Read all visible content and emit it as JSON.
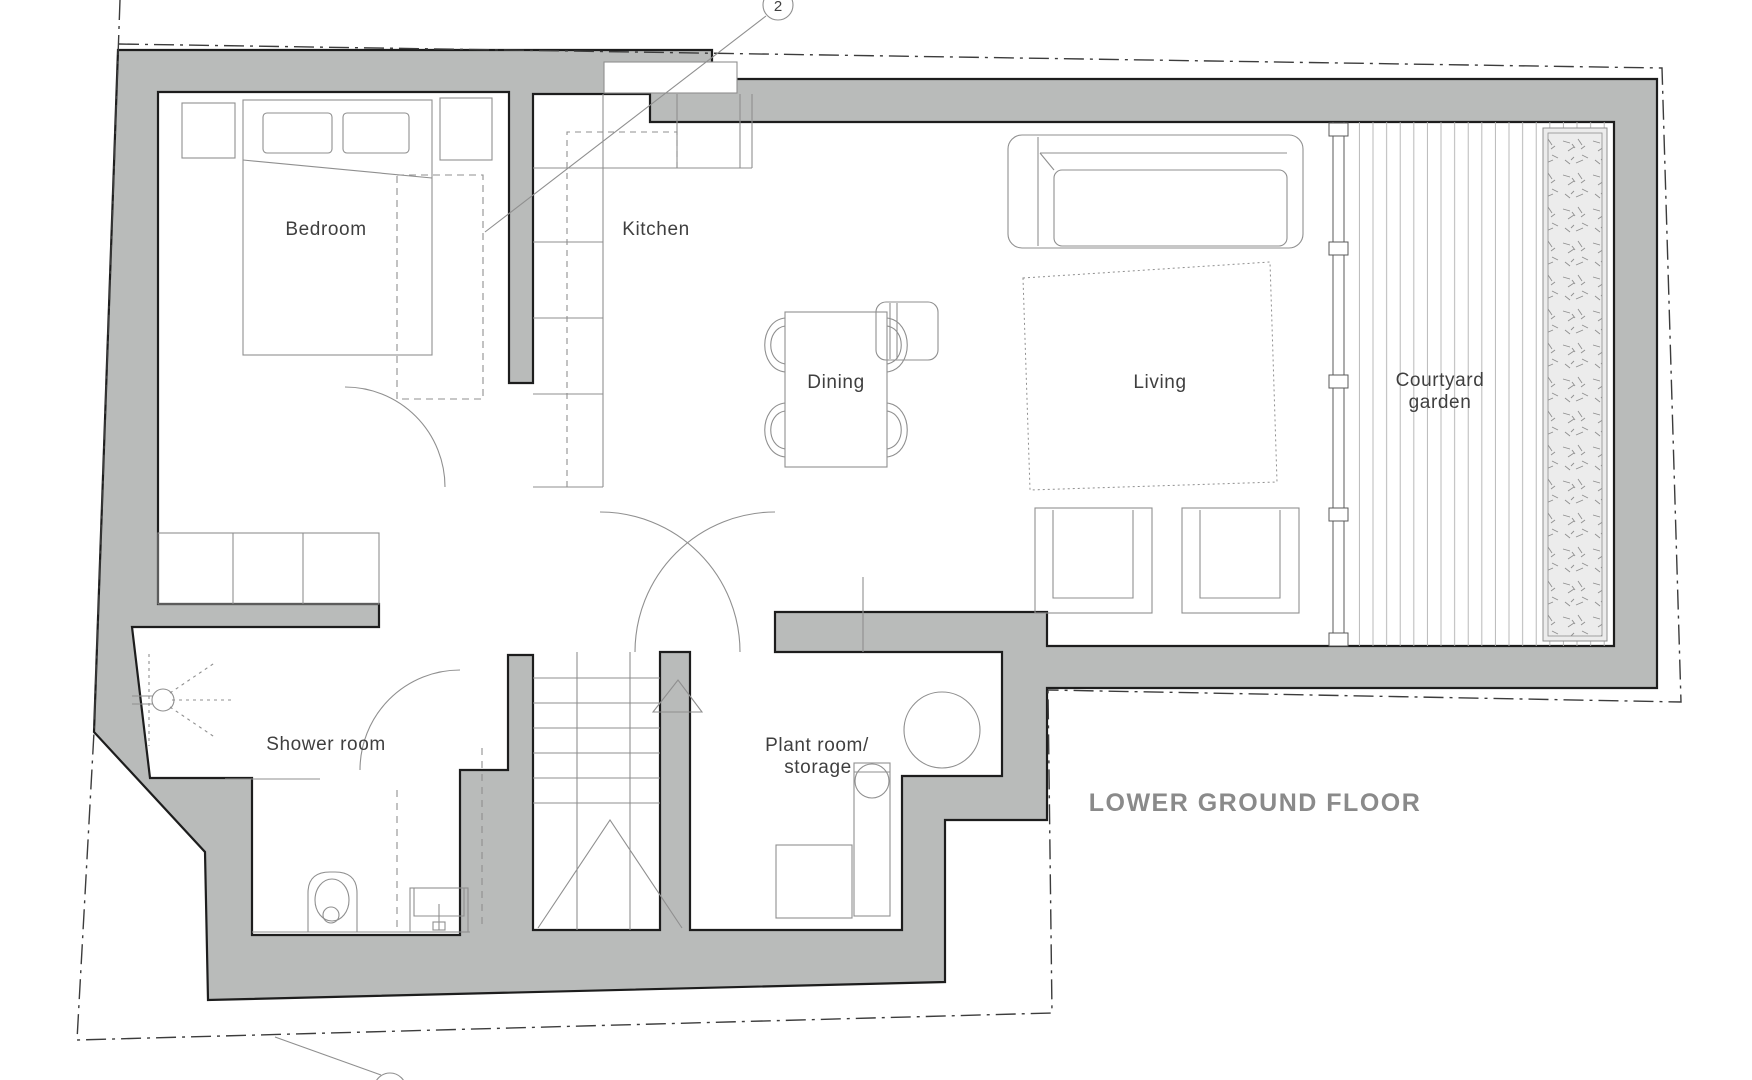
{
  "plan": {
    "title": "LOWER GROUND FLOOR",
    "rooms": {
      "bedroom": "Bedroom",
      "kitchen": "Kitchen",
      "dining": "Dining",
      "living": "Living",
      "courtyard_line1": "Courtyard",
      "courtyard_line2": "garden",
      "shower": "Shower room",
      "plant_line1": "Plant room/",
      "plant_line2": "storage"
    },
    "markers": {
      "section_top": "2",
      "section_bottom": ""
    },
    "colors": {
      "wall_fill": "#b9bbba",
      "wall_outline": "#1d1d1d",
      "furniture_line": "#8f8f8f",
      "boundary_line": "#3c3c3c",
      "label_text": "#3f3f3f",
      "title_text": "#8a8a8a",
      "planter_fill": "#ececec",
      "deck_line": "#b0b0b0"
    }
  }
}
